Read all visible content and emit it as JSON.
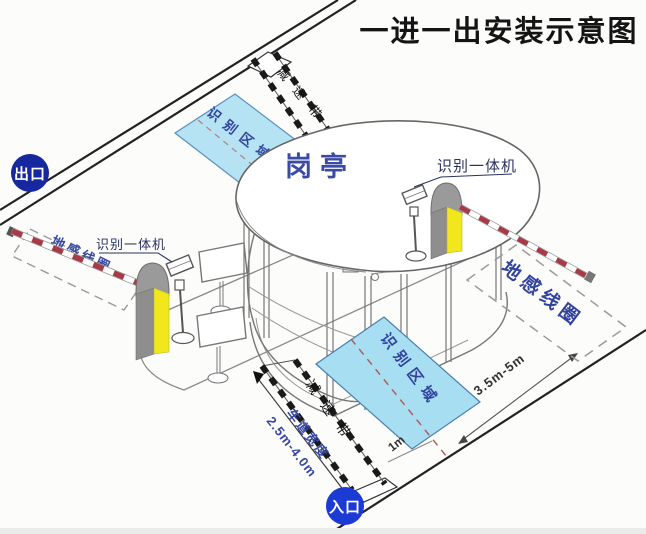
{
  "title": "一进一出安装示意图",
  "badges": {
    "exit": "出口",
    "entrance": "入口"
  },
  "booth": {
    "label": "岗亭"
  },
  "exit_lane": {
    "speed_bump": "减速带",
    "recognition_area": "识别区域",
    "ground_coil": "地感线圈",
    "camera_label": "识别一体机"
  },
  "entry_lane": {
    "speed_bump": "减速带",
    "recognition_area": "识别区域",
    "ground_coil": "地感线圈",
    "camera_label": "识别一体机",
    "lane_width_label": "车道宽度",
    "lane_width_value": "2.5m-4.0m",
    "coil_distance": "3.5m-5m",
    "centerline_offset": "1m"
  },
  "colors": {
    "area_fill": "#a8def2",
    "area_border": "#4a7fae",
    "label_blue": "#32439c",
    "badge_exit": "#16289e",
    "badge_entrance": "#1c3ad4",
    "barrier_yellow": "#f2e71d",
    "arm_red": "#a63b47",
    "title_color": "#141414"
  }
}
